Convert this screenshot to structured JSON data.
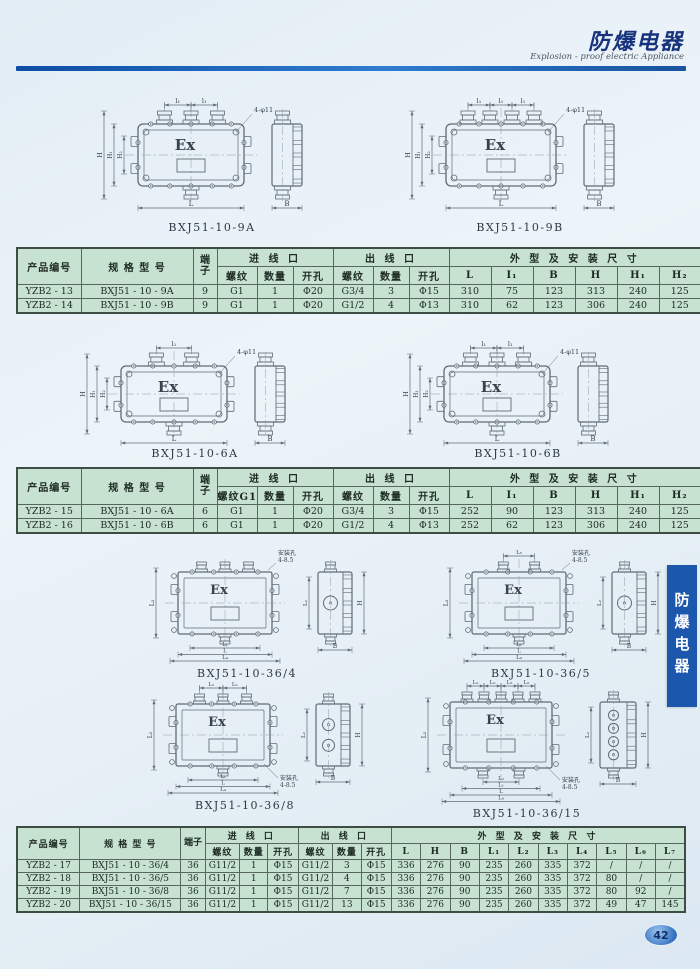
{
  "header": {
    "title": "防爆电器",
    "subtitle": "Explosion - proof electric Appliance"
  },
  "side_tab": {
    "label": "防爆电器"
  },
  "page_number": "42",
  "colors": {
    "header_blue": "#0d4da6",
    "table_green": "#c8e2d2",
    "tab_blue": "#1c57ae",
    "line_gray": "#5f6b76"
  },
  "diagrams": [
    {
      "caption": "BXJ51-10-9A",
      "ex_label": "Ex",
      "type": "wide",
      "glands_top": 3,
      "glands_bottom": 1,
      "top_dims": [
        "l₁",
        "l₁"
      ],
      "left_dims": [
        "H",
        "H₁",
        "H₂"
      ],
      "bottom_dims": [
        "L"
      ],
      "side_width_label": "B",
      "side_dims": [],
      "side_circles": 0,
      "hole_note": "4-φ11",
      "hole_note_pos": "top-right"
    },
    {
      "caption": "BXJ51-10-9B",
      "ex_label": "Ex",
      "type": "wide",
      "glands_top": 4,
      "glands_bottom": 1,
      "top_dims": [
        "l₁",
        "l₁",
        "l₁"
      ],
      "left_dims": [
        "H",
        "H₁",
        "H₂"
      ],
      "bottom_dims": [
        "L"
      ],
      "side_width_label": "B",
      "side_dims": [],
      "side_circles": 0,
      "hole_note": "4-φ11",
      "hole_note_pos": "top-right"
    },
    {
      "caption": "BXJ51-10-6A",
      "ex_label": "Ex",
      "type": "wide",
      "glands_top": 2,
      "glands_bottom": 1,
      "top_dims": [
        "l₁"
      ],
      "left_dims": [
        "H",
        "H₁",
        "H₂"
      ],
      "bottom_dims": [
        "L"
      ],
      "side_width_label": "B",
      "side_dims": [],
      "side_circles": 0,
      "hole_note": "4-φ11",
      "hole_note_pos": "top-right"
    },
    {
      "caption": "BXJ51-10-6B",
      "ex_label": "Ex",
      "type": "wide",
      "glands_top": 3,
      "glands_bottom": 1,
      "top_dims": [
        "l₁",
        "l₁"
      ],
      "left_dims": [
        "H",
        "H₁",
        "H₂"
      ],
      "bottom_dims": [
        "L"
      ],
      "side_width_label": "B",
      "side_dims": [],
      "side_circles": 0,
      "hole_note": "4-φ11",
      "hole_note_pos": "top-right"
    },
    {
      "caption": "BXJ51-10-36/4",
      "ex_label": "Ex",
      "type": "square",
      "glands_top": 3,
      "glands_bottom": 1,
      "top_dims": [],
      "left_dims": [
        "L₃"
      ],
      "bottom_dims": [
        "L₁",
        "L",
        "L₄"
      ],
      "side_width_label": "B",
      "side_dims": [
        "L₂",
        "H"
      ],
      "side_circles": 1,
      "hole_note": "安装孔 4-8.5",
      "hole_note_pos": "top-right"
    },
    {
      "caption": "BXJ51-10-36/5",
      "ex_label": "Ex",
      "type": "square",
      "glands_top": 2,
      "glands_bottom": 1,
      "top_dims": [
        "L₅"
      ],
      "left_dims": [
        "L₃"
      ],
      "bottom_dims": [
        "L₁",
        "L",
        "L₄"
      ],
      "side_width_label": "B",
      "side_dims": [
        "L₂",
        "H"
      ],
      "side_circles": 1,
      "hole_note": "安装孔 4-8.5",
      "hole_note_pos": "top-right"
    },
    {
      "caption": "BXJ51-10-36/8",
      "ex_label": "Ex",
      "type": "square",
      "glands_top": 3,
      "glands_bottom": 1,
      "top_dims": [
        "L₅",
        "L₅"
      ],
      "left_dims": [
        "L₃"
      ],
      "bottom_dims": [
        "L₁",
        "L",
        "L₄"
      ],
      "side_width_label": "B",
      "side_dims": [
        "L₂",
        "H"
      ],
      "side_circles": 2,
      "hole_note": "安装孔 4-8.5",
      "hole_note_pos": "bottom-right"
    },
    {
      "caption": "BXJ51-10-36/15",
      "ex_label": "Ex",
      "type": "square",
      "glands_top": 5,
      "glands_bottom": 2,
      "top_dims": [
        "L₅",
        "L₅",
        "L₅",
        "L₅"
      ],
      "left_dims": [
        "L₃"
      ],
      "bottom_dims": [
        "L₂",
        "L₁",
        "L",
        "L₄"
      ],
      "side_width_label": "B",
      "side_dims": [
        "L₂",
        "H"
      ],
      "side_circles": 4,
      "hole_note": "安装孔 4-8.5",
      "hole_note_pos": "bottom-right"
    }
  ],
  "tables": [
    {
      "group_headers": [
        {
          "label": "产品编号",
          "rowspan": 2
        },
        {
          "label": "规 格 型 号",
          "rowspan": 2
        },
        {
          "label": "端子",
          "rowspan": 2,
          "vertical": true
        },
        {
          "label": "进 线 口",
          "colspan": 3
        },
        {
          "label": "出 线 口",
          "colspan": 3
        },
        {
          "label": "外 型 及 安 装 尺 寸",
          "colspan": 6
        }
      ],
      "sub_headers": [
        "螺纹",
        "数量",
        "开孔",
        "螺纹",
        "数量",
        "开孔",
        "L",
        "I₁",
        "B",
        "H",
        "H₁",
        "H₂"
      ],
      "rows": [
        [
          "YZB2 - 13",
          "BXJ51 - 10 - 9A",
          "9",
          "G1",
          "1",
          "Φ20",
          "G3/4",
          "3",
          "Φ15",
          "310",
          "75",
          "123",
          "313",
          "240",
          "125"
        ],
        [
          "YZB2 - 14",
          "BXJ51 - 10 - 9B",
          "9",
          "G1",
          "1",
          "Φ20",
          "G1/2",
          "4",
          "Φ13",
          "310",
          "62",
          "123",
          "306",
          "240",
          "125"
        ]
      ]
    },
    {
      "group_headers": [
        {
          "label": "产品编号",
          "rowspan": 2
        },
        {
          "label": "规 格 型 号",
          "rowspan": 2
        },
        {
          "label": "端子",
          "rowspan": 2,
          "vertical": true
        },
        {
          "label": "进 线 口",
          "colspan": 3
        },
        {
          "label": "出 线 口",
          "colspan": 3
        },
        {
          "label": "外 型 及 安 装 尺 寸",
          "colspan": 6
        }
      ],
      "sub_headers": [
        "螺纹G1",
        "数量",
        "开孔",
        "螺纹",
        "数量",
        "开孔",
        "L",
        "I₁",
        "B",
        "H",
        "H₁",
        "H₂"
      ],
      "rows": [
        [
          "YZB2 - 15",
          "BXJ51 - 10 - 6A",
          "6",
          "G1",
          "1",
          "Φ20",
          "G3/4",
          "3",
          "Φ15",
          "252",
          "90",
          "123",
          "313",
          "240",
          "125"
        ],
        [
          "YZB2 - 16",
          "BXJ51 - 10 - 6B",
          "6",
          "G1",
          "1",
          "Φ20",
          "G1/2",
          "4",
          "Φ13",
          "252",
          "62",
          "123",
          "306",
          "240",
          "125"
        ]
      ]
    },
    {
      "group_headers": [
        {
          "label": "产品编号",
          "rowspan": 2
        },
        {
          "label": "规 格 型 号",
          "rowspan": 2
        },
        {
          "label": "端子",
          "rowspan": 2,
          "vertical": true
        },
        {
          "label": "进 线 口",
          "colspan": 3
        },
        {
          "label": "出 线 口",
          "colspan": 3
        },
        {
          "label": "外 型 及 安 装 尺 寸",
          "colspan": 10
        }
      ],
      "sub_headers": [
        "螺纹",
        "数量",
        "开孔",
        "螺纹",
        "数量",
        "开孔",
        "L",
        "H",
        "B",
        "L₁",
        "L₂",
        "L₃",
        "L₄",
        "L₅",
        "L₆",
        "L₇"
      ],
      "rows": [
        [
          "YZB2 - 17",
          "BXJ51 - 10 - 36/4",
          "36",
          "G11/2",
          "1",
          "Φ15",
          "G11/2",
          "3",
          "Φ15",
          "336",
          "276",
          "90",
          "235",
          "260",
          "335",
          "372",
          "/",
          "/",
          "/"
        ],
        [
          "YZB2 - 18",
          "BXJ51 - 10 - 36/5",
          "36",
          "G11/2",
          "1",
          "Φ15",
          "G11/2",
          "4",
          "Φ15",
          "336",
          "276",
          "90",
          "235",
          "260",
          "335",
          "372",
          "80",
          "/",
          "/"
        ],
        [
          "YZB2 - 19",
          "BXJ51 - 10 - 36/8",
          "36",
          "G11/2",
          "1",
          "Φ15",
          "G11/2",
          "7",
          "Φ15",
          "336",
          "276",
          "90",
          "235",
          "260",
          "335",
          "372",
          "80",
          "92",
          "/"
        ],
        [
          "YZB2 - 20",
          "BXJ51 - 10 - 36/15",
          "36",
          "G11/2",
          "1",
          "Φ15",
          "G11/2",
          "13",
          "Φ15",
          "336",
          "276",
          "90",
          "235",
          "260",
          "335",
          "372",
          "49",
          "47",
          "145"
        ]
      ]
    }
  ]
}
